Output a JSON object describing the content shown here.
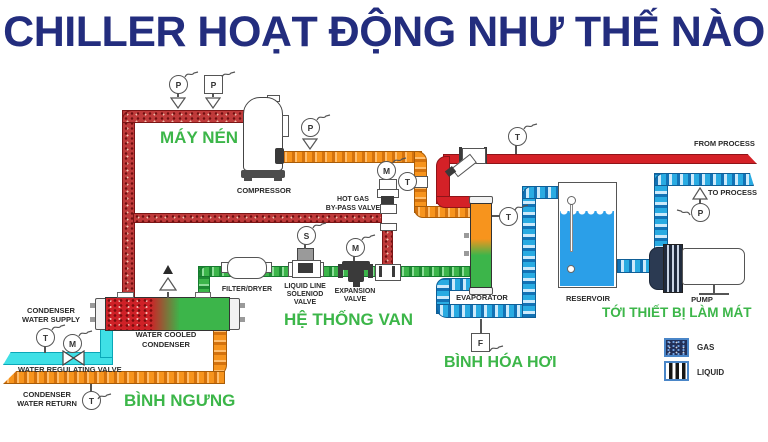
{
  "title": "CHILLER HOẠT ĐỘNG NHƯ THẾ NÀO",
  "gauges": {
    "pressure": "P",
    "temperature": "T",
    "motor": "M",
    "solenoid": "S",
    "flow": "F"
  },
  "equipment": {
    "compressor": "COMPRESSOR",
    "filter_dryer": "FILTER/DRYER",
    "evaporator": "EVAPORATOR",
    "reservoir": "RESERVOIR",
    "pump": "PUMP"
  },
  "valves": {
    "hot_gas_line1": "HOT GAS",
    "hot_gas_line2": "BY-PASS VALVE",
    "solenoid_line1": "LIQUID LINE",
    "solenoid_line2": "SOLENIOD",
    "solenoid_line3": "VALVE",
    "expansion_line1": "EXPANSION",
    "expansion_line2": "VALVE",
    "regulating": "WATER REGULATING VALVE"
  },
  "water": {
    "supply_line1": "CONDENSER",
    "supply_line2": "WATER SUPPLY",
    "return_line1": "CONDENSER",
    "return_line2": "WATER RETURN",
    "cooled_line1": "WATER COOLED",
    "cooled_line2": "CONDENSER",
    "from_process": "FROM PROCESS",
    "to_process": "TO PROCESS"
  },
  "vietnamese": {
    "may_nen": "MÁY NÉN",
    "he_thong_van": "HỆ THỐNG VAN",
    "binh_ngung": "BÌNH NGƯNG",
    "binh_hoa_hoi": "BÌNH HÓA HƠI",
    "toi_thiet_bi": "TỚI THIẾT BỊ LÀM MÁT"
  },
  "legend": {
    "gas": "GAS",
    "liquid": "LIQUID"
  },
  "colors": {
    "title_navy": "#232d7e",
    "label_green": "#3cb649",
    "hot_gas_red": "#bf3a3a",
    "process_red": "#d42127",
    "suction_orange": "#f7941d",
    "liquid_green": "#3cb54a",
    "chilled_blue": "#29abe2",
    "supply_cyan": "#3fe0e6"
  }
}
